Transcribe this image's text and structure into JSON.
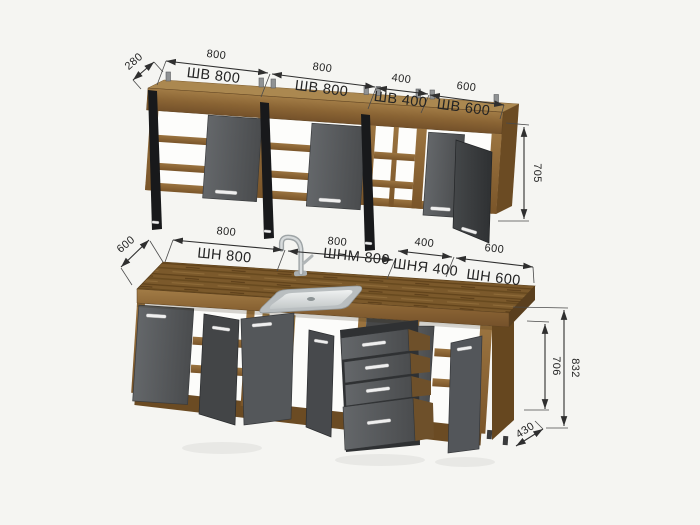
{
  "drawing": {
    "type": "kitchen-set-dimension-drawing",
    "upper_row": {
      "depth": "280",
      "height": "705",
      "cabinets": [
        {
          "width": "800",
          "label": "ШВ 800"
        },
        {
          "width": "800",
          "label": "ШВ 800"
        },
        {
          "width": "400",
          "label": "ШВ 400"
        },
        {
          "width": "600",
          "label": "ШВ 600"
        }
      ]
    },
    "lower_row": {
      "depth": "600",
      "base_depth": "430",
      "inner_height": "706",
      "total_height": "832",
      "cabinets": [
        {
          "width": "800",
          "label": "ШН 800"
        },
        {
          "width": "800",
          "label": "ШНМ 800"
        },
        {
          "width": "400",
          "label": "ШНЯ 400"
        },
        {
          "width": "600",
          "label": "ШН 600"
        }
      ]
    },
    "colors": {
      "background": "#f5f5f2",
      "wood": "#8a6434",
      "wood_dark": "#664721",
      "countertop": "#7b592b",
      "door_gray": "#575a5c",
      "door_open_dark": "#3f4143",
      "door_edge_black": "#1a1b1d",
      "dimension_line": "#2f2f2f",
      "sink_metal": "#c6cbcd"
    }
  }
}
